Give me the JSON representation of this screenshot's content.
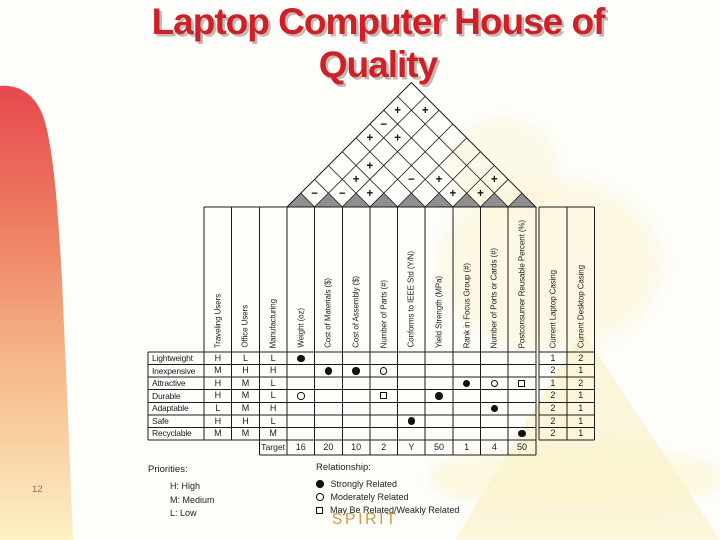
{
  "slide": {
    "title_line1": "Laptop Computer House of",
    "title_line2": "Quality",
    "page_number": "12",
    "footer": "SPIRIT"
  },
  "colors": {
    "title_red": "#cc2127",
    "footer_orange": "#cf9a41",
    "table_line": "#1c1c1c",
    "roof_triangle_gray": "#8f8f8f",
    "left_gradient_top": "#e8484e",
    "left_gradient_bottom": "#fcf2c4"
  },
  "house": {
    "priority_columns": [
      "Traveling Users",
      "Office Users",
      "Manufacturing"
    ],
    "data_columns": [
      "Weight (oz)",
      "Cost of Materials ($)",
      "Cost of Assembly ($)",
      "Number of Parts (#)",
      "Conforms to IEEE Std (Y/N)",
      "Yield Strength (MPa)",
      "Rank in Focus Group (#)",
      "Number of Ports or Cards (#)",
      "Postconsumer Reusable Percent (%)"
    ],
    "benchmark_columns": [
      "Current Laptop Casing",
      "Current Desktop Casing"
    ],
    "rows": [
      {
        "label": "Lightweight",
        "priorities": [
          "H",
          "L",
          "L"
        ],
        "relationships": [
          "strong",
          "",
          "",
          "",
          "",
          "",
          "",
          "",
          ""
        ],
        "benchmarks": [
          "1",
          "2"
        ]
      },
      {
        "label": "Inexpensive",
        "priorities": [
          "M",
          "H",
          "H"
        ],
        "relationships": [
          "",
          "strong",
          "strong",
          "moderate",
          "",
          "",
          "",
          "",
          ""
        ],
        "benchmarks": [
          "2",
          "1"
        ]
      },
      {
        "label": "Attractive",
        "priorities": [
          "H",
          "M",
          "L"
        ],
        "relationships": [
          "",
          "",
          "",
          "",
          "",
          "",
          "strong",
          "moderate",
          "weak"
        ],
        "benchmarks": [
          "1",
          "2"
        ]
      },
      {
        "label": "Durable",
        "priorities": [
          "H",
          "M",
          "L"
        ],
        "relationships": [
          "moderate",
          "",
          "",
          "weak",
          "",
          "strong",
          "",
          "",
          ""
        ],
        "benchmarks": [
          "2",
          "1"
        ]
      },
      {
        "label": "Adaptable",
        "priorities": [
          "L",
          "M",
          "H"
        ],
        "relationships": [
          "",
          "",
          "",
          "",
          "",
          "",
          "",
          "strong",
          ""
        ],
        "benchmarks": [
          "2",
          "1"
        ]
      },
      {
        "label": "Safe",
        "priorities": [
          "H",
          "H",
          "L"
        ],
        "relationships": [
          "",
          "",
          "",
          "",
          "strong",
          "",
          "",
          "",
          ""
        ],
        "benchmarks": [
          "2",
          "1"
        ]
      },
      {
        "label": "Recyclable",
        "priorities": [
          "M",
          "M",
          "M"
        ],
        "relationships": [
          "",
          "",
          "",
          "",
          "",
          "",
          "",
          "",
          "strong"
        ],
        "benchmarks": [
          "2",
          "1"
        ]
      }
    ],
    "target_label": "Target",
    "targets": [
      "16",
      "20",
      "10",
      "2",
      "Y",
      "50",
      "1",
      "4",
      "50"
    ],
    "roof_cells": [
      {
        "a": 1,
        "b": 8,
        "s": "+"
      },
      {
        "a": 2,
        "b": 9,
        "s": "+"
      },
      {
        "a": 1,
        "b": 7,
        "s": "−"
      },
      {
        "a": 1,
        "b": 6,
        "s": "+"
      },
      {
        "a": 2,
        "b": 7,
        "s": "+"
      },
      {
        "a": 2,
        "b": 5,
        "s": "+"
      },
      {
        "a": 2,
        "b": 4,
        "s": "+"
      },
      {
        "a": 4,
        "b": 6,
        "s": "−"
      },
      {
        "a": 5,
        "b": 7,
        "s": "+"
      },
      {
        "a": 7,
        "b": 9,
        "s": "+"
      },
      {
        "a": 1,
        "b": 2,
        "s": "−"
      },
      {
        "a": 2,
        "b": 3,
        "s": "−"
      },
      {
        "a": 3,
        "b": 4,
        "s": "+"
      },
      {
        "a": 6,
        "b": 7,
        "s": "+"
      },
      {
        "a": 7,
        "b": 8,
        "s": "+"
      }
    ]
  },
  "legend": {
    "priorities_title": "Priorities:",
    "priorities_items": [
      "H: High",
      "M: Medium",
      "L: Low"
    ],
    "relationship_title": "Relationship:",
    "relationship_items": [
      {
        "sym": "strong",
        "label": "Strongly Related"
      },
      {
        "sym": "moderate",
        "label": "Moderately Related"
      },
      {
        "sym": "weak",
        "label": "May Be Related/Weakly Related"
      }
    ]
  }
}
